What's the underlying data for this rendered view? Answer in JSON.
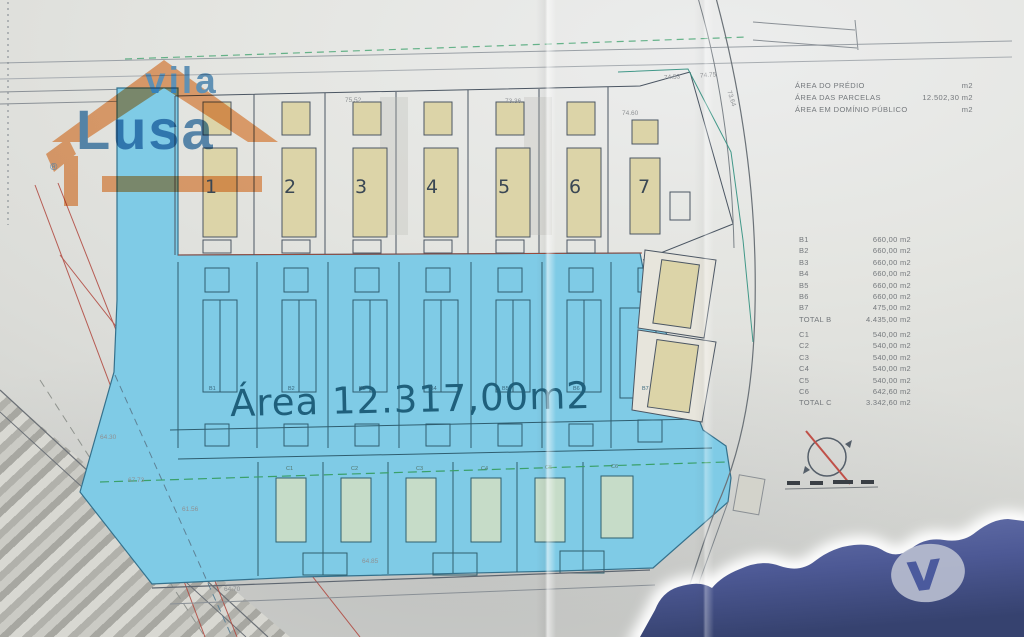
{
  "watermark": {
    "word1": "vila",
    "word2": "Lusa",
    "registered": "®"
  },
  "corner_logo": {
    "letter": "v"
  },
  "area_label": "Área 12.317,00m2",
  "summary": {
    "rows": [
      {
        "label": "ÁREA  DO PRÉDIO",
        "value": "m2"
      },
      {
        "label": "ÁREA  DAS PARCELAS",
        "value": "12.502,30 m2"
      },
      {
        "label": "ÁREA  EM DOMÍNIO PÚBLICO",
        "value": "m2"
      }
    ]
  },
  "table_b": {
    "rows": [
      {
        "label": "B1",
        "value": "660,00 m2"
      },
      {
        "label": "B2",
        "value": "660,00 m2"
      },
      {
        "label": "B3",
        "value": "660,00 m2"
      },
      {
        "label": "B4",
        "value": "660,00 m2"
      },
      {
        "label": "B5",
        "value": "660,00 m2"
      },
      {
        "label": "B6",
        "value": "660,00 m2"
      },
      {
        "label": "B7",
        "value": "475,00 m2"
      },
      {
        "label": "TOTAL B",
        "value": "4.435,00 m2"
      }
    ]
  },
  "table_c": {
    "rows": [
      {
        "label": "C1",
        "value": "540,00 m2"
      },
      {
        "label": "C2",
        "value": "540,00 m2"
      },
      {
        "label": "C3",
        "value": "540,00 m2"
      },
      {
        "label": "C4",
        "value": "540,00 m2"
      },
      {
        "label": "C5",
        "value": "540,00 m2"
      },
      {
        "label": "C6",
        "value": "642,60 m2"
      },
      {
        "label": "TOTAL C",
        "value": "3.342,60 m2"
      }
    ]
  },
  "lots": [
    "1",
    "2",
    "3",
    "4",
    "5",
    "6",
    "7"
  ],
  "b_labels": [
    "B1",
    "B2",
    "B3",
    "B4",
    "B5",
    "B6",
    "B7"
  ],
  "c_labels": [
    "C1",
    "C2",
    "C3",
    "C4",
    "C5",
    "C6"
  ],
  "dimensions": [
    "75.52",
    "73.36",
    "74.60",
    "74.53",
    "74.75",
    "73.64",
    "67.73",
    "61.56",
    "64.85",
    "64.70",
    "64.30"
  ],
  "colors": {
    "highlight_blue": "#7fcbe6",
    "lot_fill_tan": "#dcd4a8",
    "lot_fill_green": "#c6dcc8",
    "logo_orange": "#ef9757",
    "logo_blue": "#3d7cb2",
    "silhouette_blue": "#4d5995",
    "boundary_green": "#3aa06a",
    "red_line": "#b0453c"
  }
}
